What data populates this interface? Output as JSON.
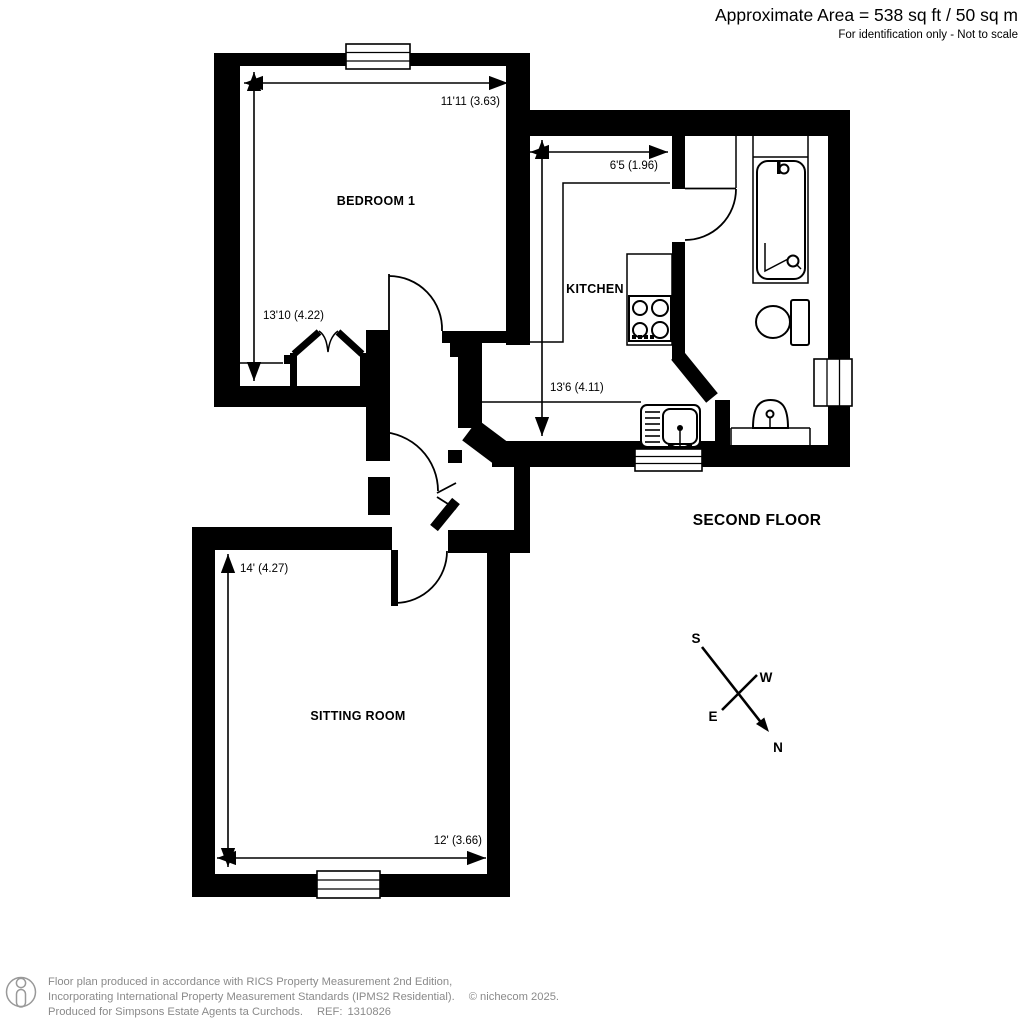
{
  "header": {
    "area_text": "Approximate Area = 538 sq ft / 50 sq m",
    "disclaimer": "For identification only - Not to scale"
  },
  "floor_label": "SECOND FLOOR",
  "rooms": {
    "bedroom": {
      "name": "BEDROOM 1",
      "width_label": "11'11 (3.63)",
      "height_label": "13'10 (4.22)"
    },
    "kitchen": {
      "name": "KITCHEN",
      "width_label": "6'5 (1.96)",
      "height_label": "13'6 (4.11)"
    },
    "sitting_room": {
      "name": "SITTING ROOM",
      "width_label": "12' (3.66)",
      "height_label": "14' (4.27)"
    }
  },
  "compass": {
    "n": "N",
    "s": "S",
    "e": "E",
    "w": "W"
  },
  "footer": {
    "line1": "Floor plan produced in accordance with RICS Property Measurement 2nd Edition,",
    "line2": "Incorporating International Property Measurement Standards (IPMS2 Residential).",
    "copyright": "© nichecom 2025.",
    "line3": "Produced for Simpsons Estate Agents ta Curchods.",
    "ref_label": "REF:",
    "ref_number": "1310826"
  },
  "colors": {
    "wall": "#000000",
    "background": "#ffffff",
    "footer_text": "#8a8a8a"
  }
}
